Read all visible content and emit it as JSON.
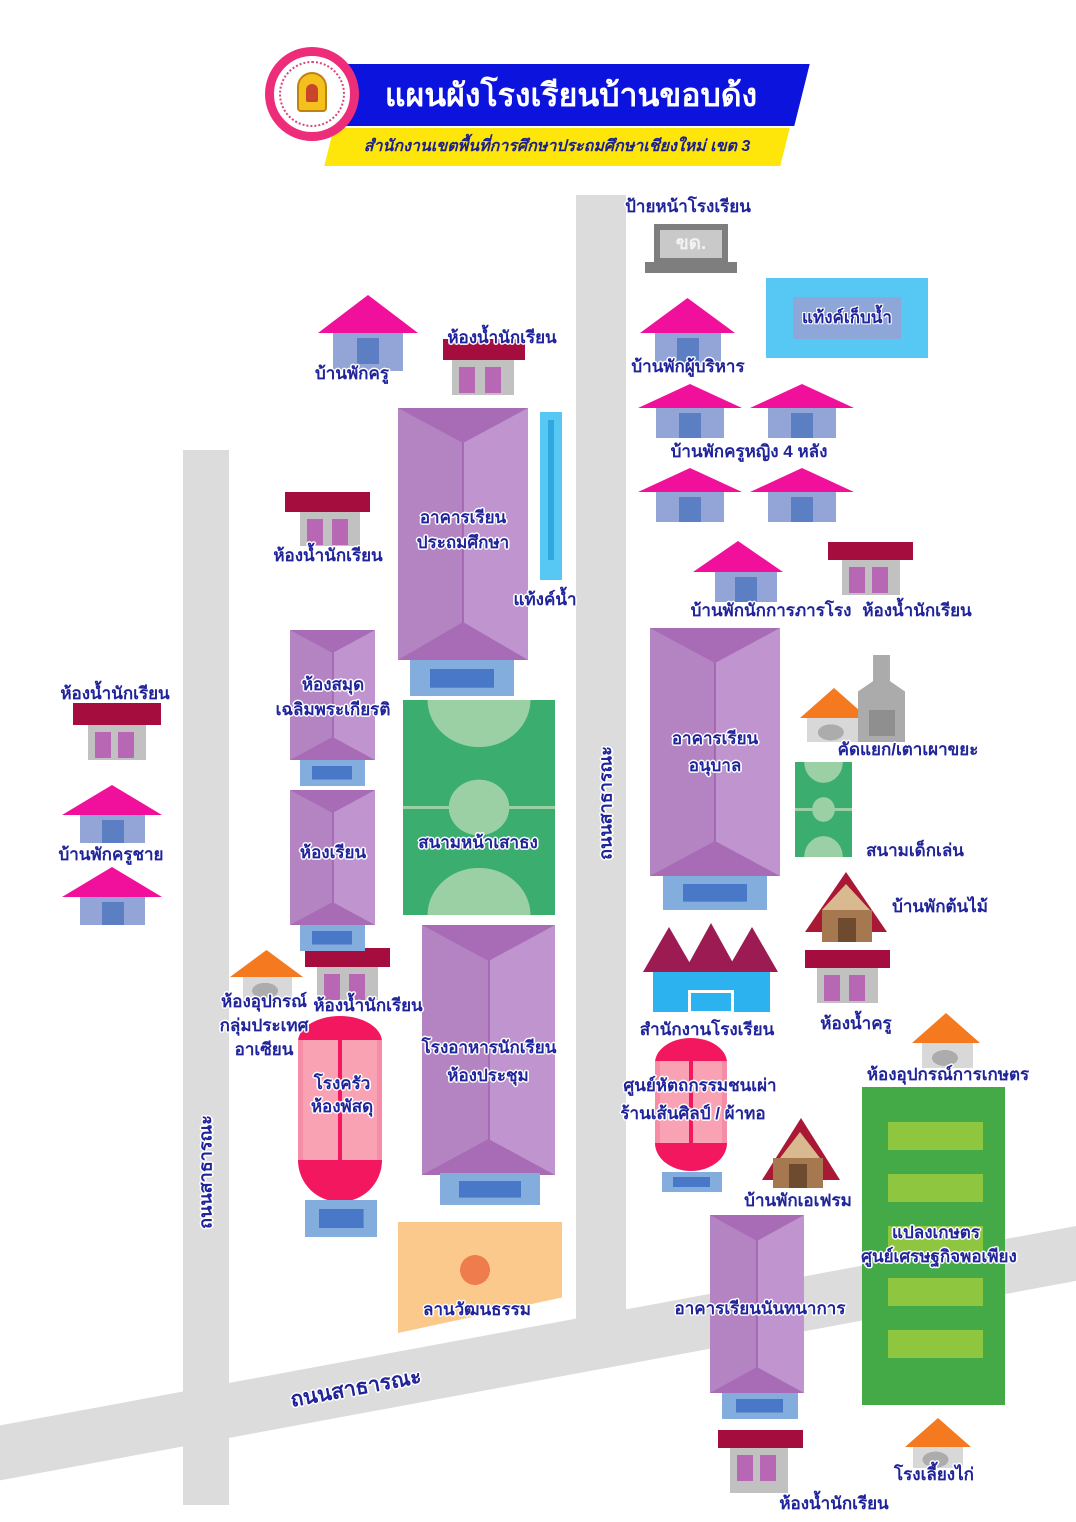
{
  "header": {
    "title": "แผนผังโรงเรียนบ้านขอบด้ง",
    "subtitle": "สำนักงานเขตพื้นที่การศึกษาประถมศึกษาเชียงใหม่ เขต 3"
  },
  "sign": {
    "label": "ป้ายหน้าโรงเรียน",
    "text": "ขด."
  },
  "roads": {
    "name": "ถนนสาธารณะ"
  },
  "buildings": {
    "tank_large": "แท้งค์เก็บน้ำ",
    "tank_small": "แท้งค์น้ำ",
    "teacher_house": "บ้านพักครู",
    "student_toilet": "ห้องน้ำนักเรียน",
    "admin_house": "บ้านพักผู้บริหาร",
    "female_teacher_houses": "บ้านพักครูหญิง 4 หลัง",
    "primary_building": {
      "line1": "อาคารเรียน",
      "line2": "ประถมศึกษา"
    },
    "library": {
      "line1": "ห้องสมุด",
      "line2": "เฉลิมพระเกียรติ"
    },
    "janitor_house": "บ้านพักนักการภารโรง",
    "kindergarten_building": {
      "line1": "อาคารเรียน",
      "line2": "อนุบาล"
    },
    "waste_incinerator": "คัดแยก/เตาเผาขยะ",
    "flag_field": "สนามหน้าเสาธง",
    "classroom": "ห้องเรียน",
    "male_teacher_house": "บ้านพักครูชาย",
    "playground": "สนามเด็กเล่น",
    "tree_house": "บ้านพักต้นไม้",
    "teacher_toilet": "ห้องน้ำครู",
    "school_office": "สำนักงานโรงเรียน",
    "asean_room": {
      "line1": "ห้องอุปกรณ์",
      "line2": "กลุ่มประเทศ",
      "line3": "อาเซียน"
    },
    "kitchen": {
      "line1": "โรงครัว",
      "line2": "ห้องพัสดุ"
    },
    "cafeteria": {
      "line1": "โรงอาหารนักเรียน",
      "line2": "ห้องประชุม"
    },
    "craft_center": {
      "line1": "ศูนย์หัตถกรรมชนเผ่า",
      "line2": "ร้านเส้นศิลป์ / ผ้าทอ"
    },
    "aframe_house": "บ้านพักเอเฟรม",
    "culture_yard": "ลานวัฒนธรรม",
    "recreation_building": "อาคารเรียนนันทนาการ",
    "farm": {
      "line1": "แปลงเกษตร",
      "line2": "ศูนย์เศรษฐกิจพอเพียง"
    },
    "agri_equipment": "ห้องอุปกรณ์การเกษตร",
    "chicken_coop": "โรงเลี้ยงไก่"
  },
  "colors": {
    "banner_blue": "#0B13DC",
    "banner_yellow": "#FFE60A",
    "logo_ring_pink": "#EE2D7A",
    "label_blue": "#20249A",
    "roof_pink": "#F0109B",
    "house_blue": "#93A5D6",
    "door_blue": "#5C7EC2",
    "roof_crimson": "#A60D3F",
    "bath_gray": "#C2C1C1",
    "bath_door": "#B767B4",
    "building_purple": "#C094CE",
    "building_purple_dark": "#A76CB5",
    "porch_blue": "#83ADDC",
    "porch_inner": "#4A78C8",
    "field_green": "#3BAD6E",
    "field_light": "#9AD0A4",
    "tank_blue": "#57C7F3",
    "tank_inner": "#8FA6D9",
    "office_blue": "#2CB3EF",
    "office_roof": "#9B1B52",
    "hut_orange": "#F4791F",
    "kitchen_pink": "#F8A2B4",
    "kitchen_red": "#F2175E",
    "farm_green": "#44A947",
    "farm_strip": "#8FC640",
    "culture_peach": "#FBC98B",
    "culture_dot": "#EF7C4D",
    "aframe_red": "#A91834",
    "aframe_tan": "#D9B98F",
    "aframe_brown": "#A5784F",
    "road_gray": "#DCDCDC",
    "sign_gray": "#7E7E7E"
  }
}
